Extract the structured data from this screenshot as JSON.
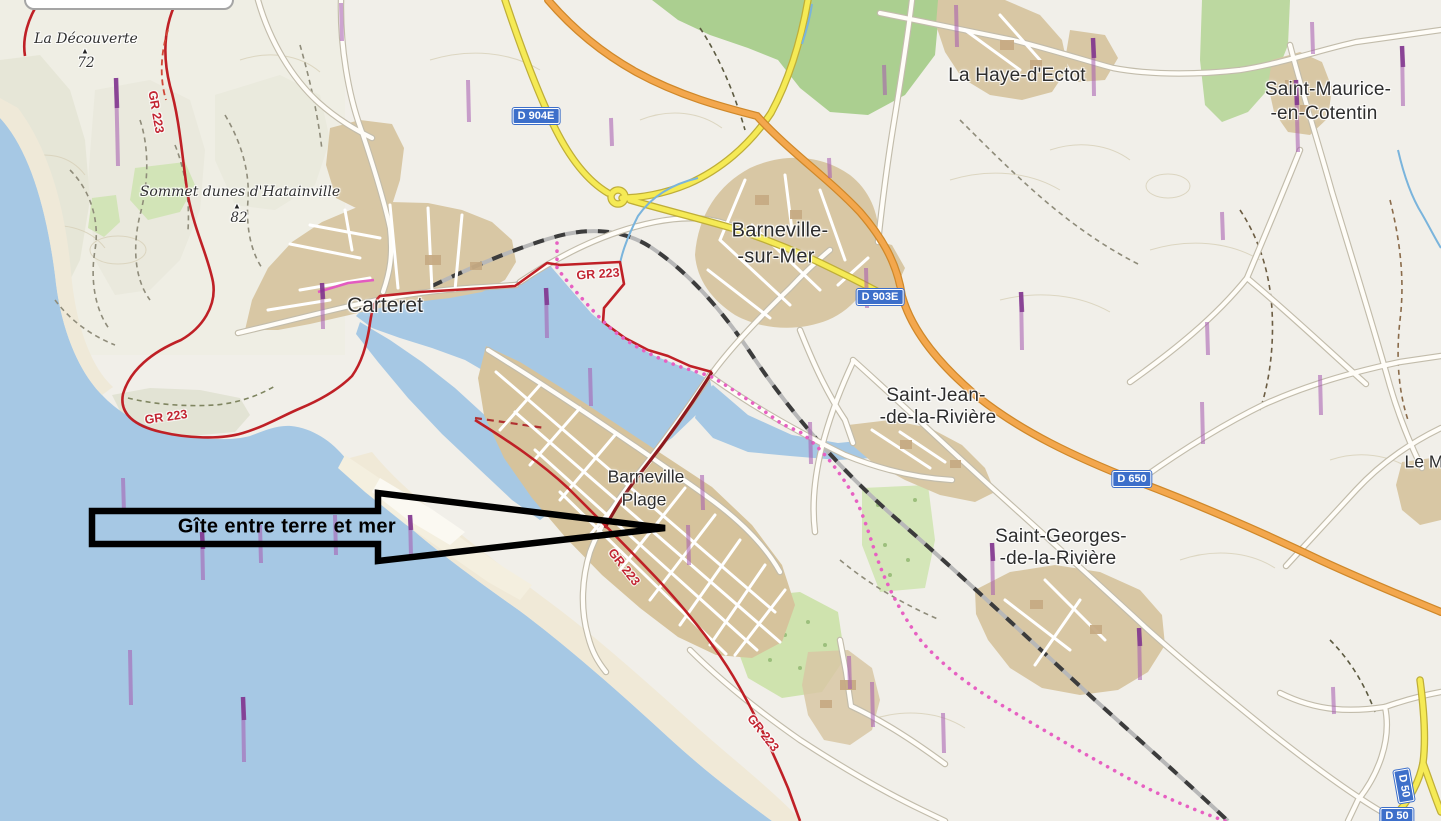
{
  "annotation": {
    "label": "Gîte entre terre et mer"
  },
  "map": {
    "towns": [
      {
        "label": "Carteret"
      },
      {
        "label": "Barneville-"
      },
      {
        "label": "-sur-Mer"
      },
      {
        "label": "La Haye-d'Ectot"
      },
      {
        "label": "Saint-Maurice-"
      },
      {
        "label": "-en-Cotentin"
      },
      {
        "label": "Saint-Jean-"
      },
      {
        "label": "-de-la-Rivière"
      },
      {
        "label": "Saint-Georges-"
      },
      {
        "label": "-de-la-Rivière"
      },
      {
        "label": "Barneville"
      },
      {
        "label": "Plage"
      },
      {
        "label": "Le M"
      }
    ],
    "hamlets": [
      {
        "label": "La Découverte"
      },
      {
        "label": "Sommet dunes d'Hatainville"
      }
    ],
    "peaks": [
      {
        "icon": "▲",
        "elevation": "72"
      },
      {
        "icon": "▲",
        "elevation": "82"
      }
    ],
    "trails": [
      {
        "label": "GR 223"
      },
      {
        "label": "GR 223"
      },
      {
        "label": "GR 223"
      },
      {
        "label": "GR 223"
      },
      {
        "label": "GR 223"
      }
    ],
    "shields": [
      {
        "ref": "D 904E"
      },
      {
        "ref": "D 903E"
      },
      {
        "ref": "D 650"
      },
      {
        "ref": "D 50"
      },
      {
        "ref": "D 50"
      }
    ]
  },
  "colors": {
    "sea": "#a6c8e4",
    "land": "#f1efe9",
    "urban": "#d8c7a4",
    "forest": "#abcf90",
    "green": "#c9e1ab",
    "road_orange": "#f3a74d",
    "road_yellow": "#f5ea55",
    "gr_trail": "#bf2026",
    "trail_pink": "#e760c2",
    "shield_blue": "#3d6fca",
    "arrow": "#000000"
  }
}
